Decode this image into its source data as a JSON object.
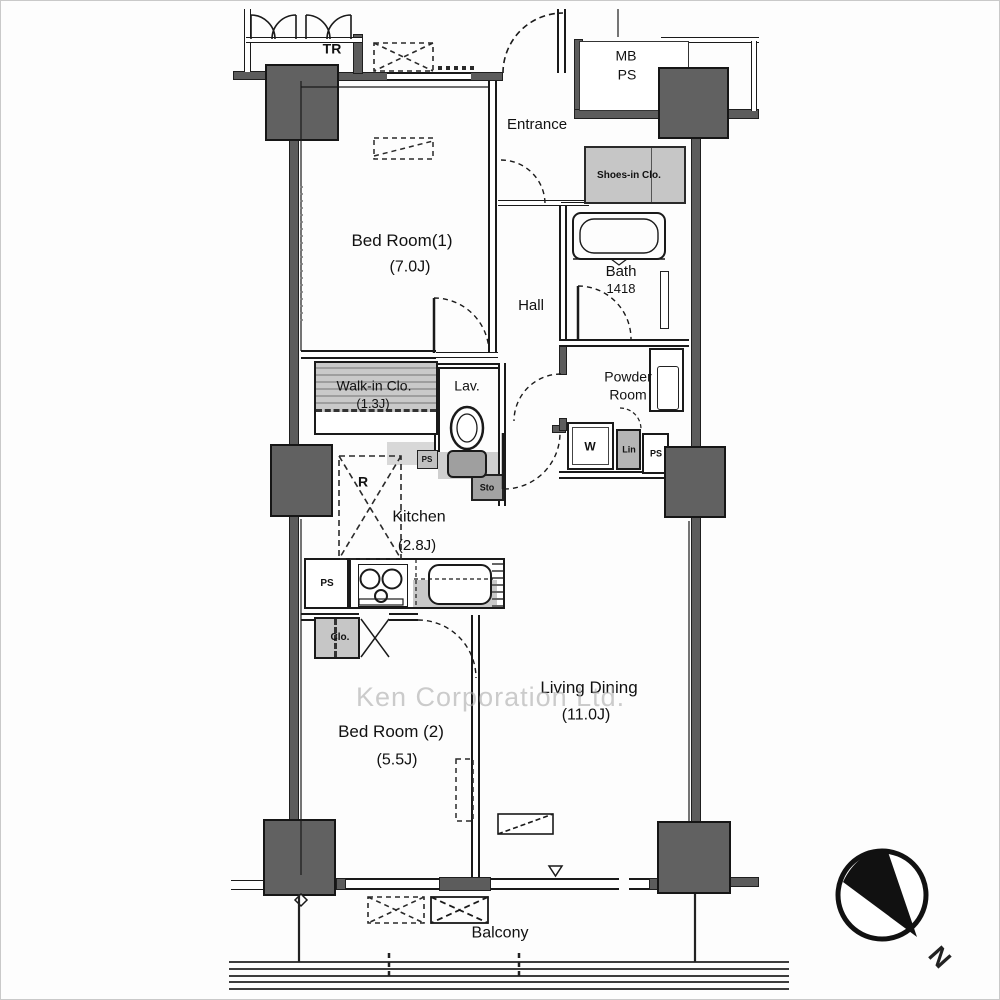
{
  "floorplan": {
    "watermark": "Ken Corporation Ltd.",
    "rooms": {
      "bedroom1": {
        "name": "Bed Room(1)",
        "size": "(7.0J)"
      },
      "bedroom2": {
        "name": "Bed Room (2)",
        "size": "(5.5J)"
      },
      "living_dining": {
        "name": "Living Dining",
        "size": "(11.0J)"
      },
      "kitchen": {
        "name": "Kitchen",
        "size": "(2.8J)"
      },
      "walk_in_closet": {
        "name": "Walk-in Clo.",
        "size": "(1.3J)"
      },
      "entrance": {
        "name": "Entrance"
      },
      "hall": {
        "name": "Hall"
      },
      "lavatory": {
        "name": "Lav."
      },
      "bath": {
        "name": "Bath",
        "size": "1418"
      },
      "powder_room": {
        "name": "Powder Room"
      },
      "balcony": {
        "name": "Balcony"
      }
    },
    "labels": {
      "trunk_room": "TR",
      "meter_box": "MB",
      "pipe_space": "PS",
      "shoes_in_closet": "Shoes-in Clo.",
      "washer": "W",
      "linen": "Lin",
      "ps_powder": "PS",
      "ps_lavatory": "PS",
      "ps_kitchen": "PS",
      "storage": "Sto",
      "refrigerator": "R",
      "closet": "Clo.",
      "north": "N"
    },
    "colors": {
      "structure": "#5c5c5c",
      "fixture_gray": "#c6c6c6",
      "line": "#1a1a1a"
    }
  }
}
